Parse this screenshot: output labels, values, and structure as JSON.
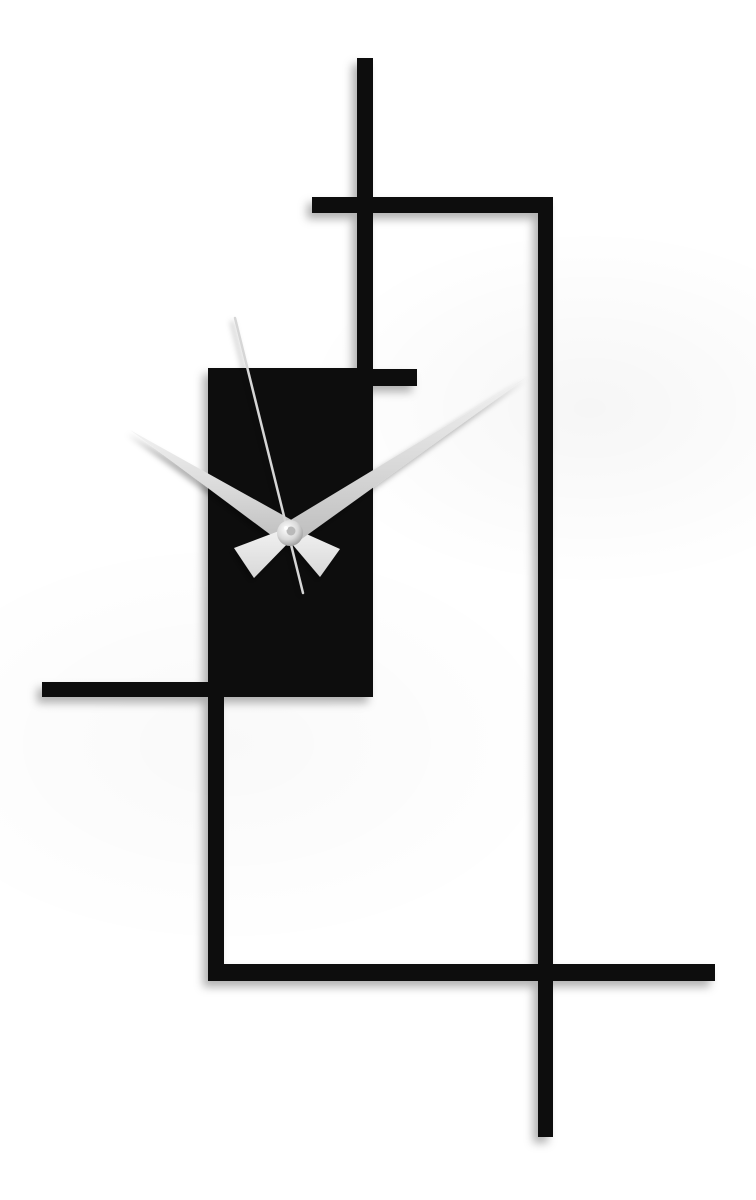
{
  "page": {
    "background": "#ffffff",
    "subject": "Minimalist geometric wall clock on white background"
  },
  "clock": {
    "description": "Abstract rectangular line-art wall clock with solid black face panel and silver hands",
    "displayed_time": "10:09",
    "second_hand_position": "57s",
    "palette": {
      "frame": "#0a0a0a",
      "hand_light": "#f2f2f2",
      "hand_mid": "#d8d8d8",
      "hand_dark": "#bdbdbd",
      "second_hand": "#d6d6d6",
      "hub_center": "#ffffff",
      "hub_edge": "#8c8c8c",
      "hub_pin": "#b9b9b9",
      "shadow": "#000000"
    }
  }
}
